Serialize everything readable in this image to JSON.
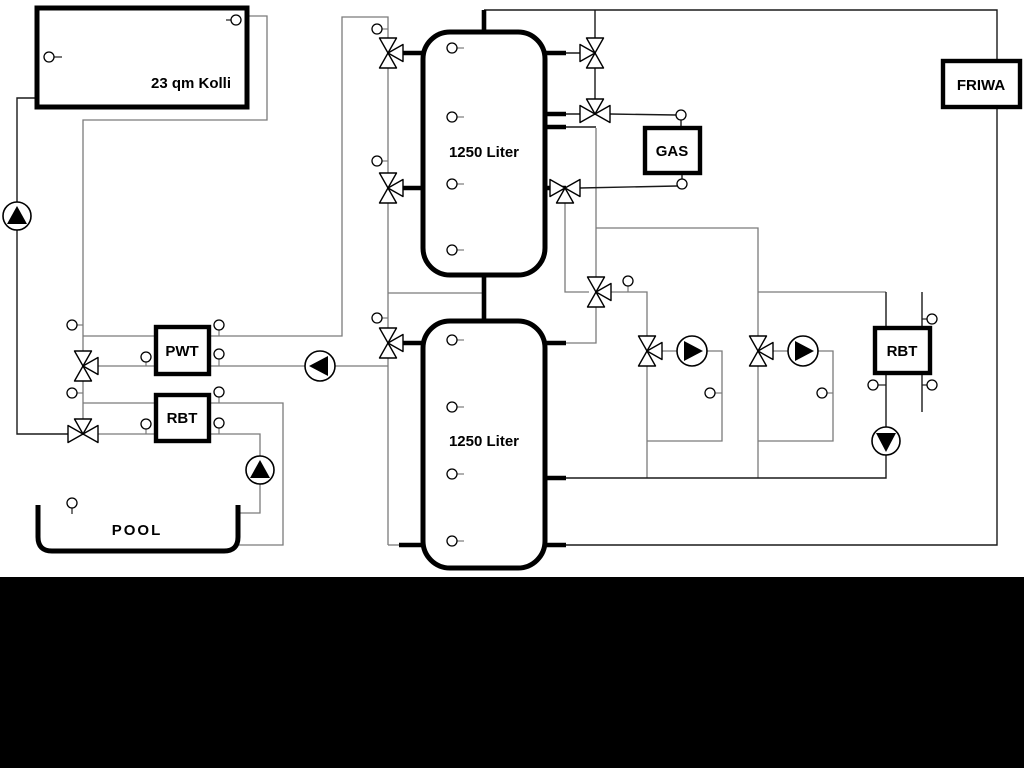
{
  "diagram": {
    "title": "heating-system-schematic",
    "colors": {
      "background": "#ffffff",
      "footer_band": "#000000",
      "primary_line": "#1a1a1a",
      "secondary_line": "#7b7b7b"
    },
    "labels": {
      "collector": "23 qm Kolli",
      "tank_top": "1250 Liter",
      "tank_bottom": "1250 Liter",
      "gas_boiler": "GAS",
      "friwa": "FRIWA",
      "pwt": "PWT",
      "rbt_left": "RBT",
      "rbt_right": "RBT",
      "pool": "POOL"
    }
  }
}
